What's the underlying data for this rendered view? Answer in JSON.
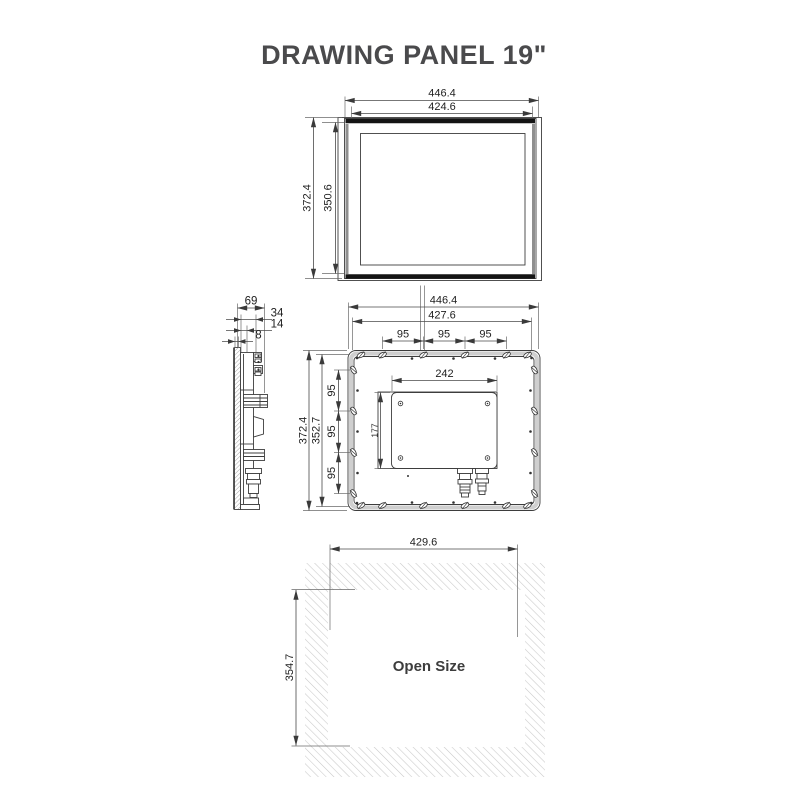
{
  "title": "DRAWING PANEL 19\"",
  "front_view": {
    "width_outer": "446.4",
    "width_screen": "424.6",
    "height_outer": "372.4",
    "height_screen": "350.6"
  },
  "side_view": {
    "depth_total": "69",
    "depth_rear": "34",
    "depth_mid": "14",
    "depth_bezel": "8"
  },
  "back_view": {
    "width_outer": "446.4",
    "width_clips": "427.6",
    "clip_pitch_top": [
      "95",
      "95",
      "95"
    ],
    "height_outer": "372.4",
    "height_clips": "352.7",
    "clip_pitch_side": [
      "95",
      "95",
      "95"
    ],
    "box_width": "242",
    "box_height": "177"
  },
  "cutout_view": {
    "label": "Open Size",
    "width": "429.6",
    "height": "354.7"
  }
}
